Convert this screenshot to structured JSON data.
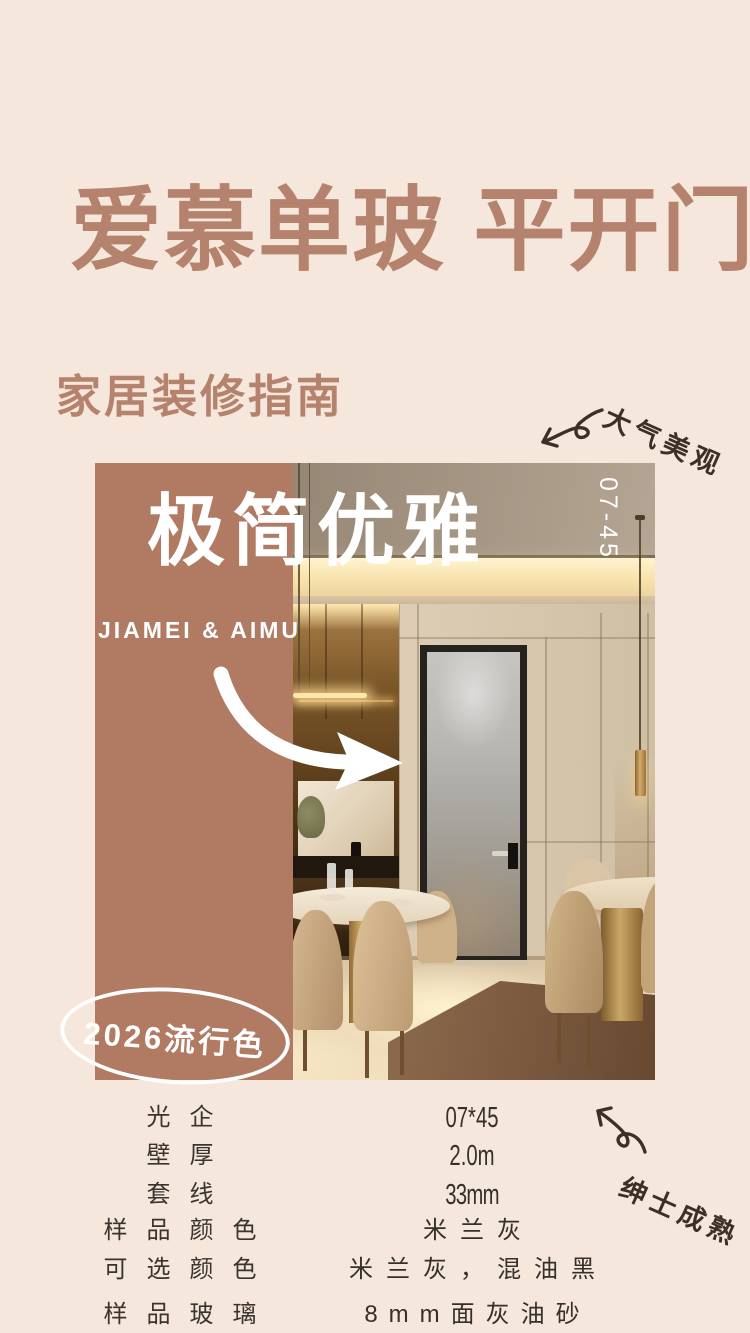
{
  "colors": {
    "background": "#f6e7dc",
    "accent_brown": "#b5826d",
    "panel_mauve": "#b17a63",
    "ink": "#3e2f26",
    "spec_text": "#3a342e",
    "white": "#ffffff"
  },
  "header": {
    "title": "爱慕单玻 平开门",
    "subtitle": "家居装修指南"
  },
  "notes": {
    "top_right": "大气美观",
    "bottom_right": "绅士成熟"
  },
  "card": {
    "headline": "极简优雅",
    "model_code": "07-45",
    "brand": "JIAMEI & AIMU",
    "badge": "2026流行色"
  },
  "specs": {
    "rows": [
      {
        "label": "光企",
        "value": "07*45"
      },
      {
        "label": "壁厚",
        "value": "2.0m"
      },
      {
        "label": "套线",
        "value": "33mm"
      },
      {
        "label": "样品颜色",
        "value": "米兰灰"
      },
      {
        "label": "可选颜色",
        "value": "米兰灰，混油黑"
      },
      {
        "label": "样品玻璃",
        "value": "8mm面灰油砂"
      }
    ]
  }
}
